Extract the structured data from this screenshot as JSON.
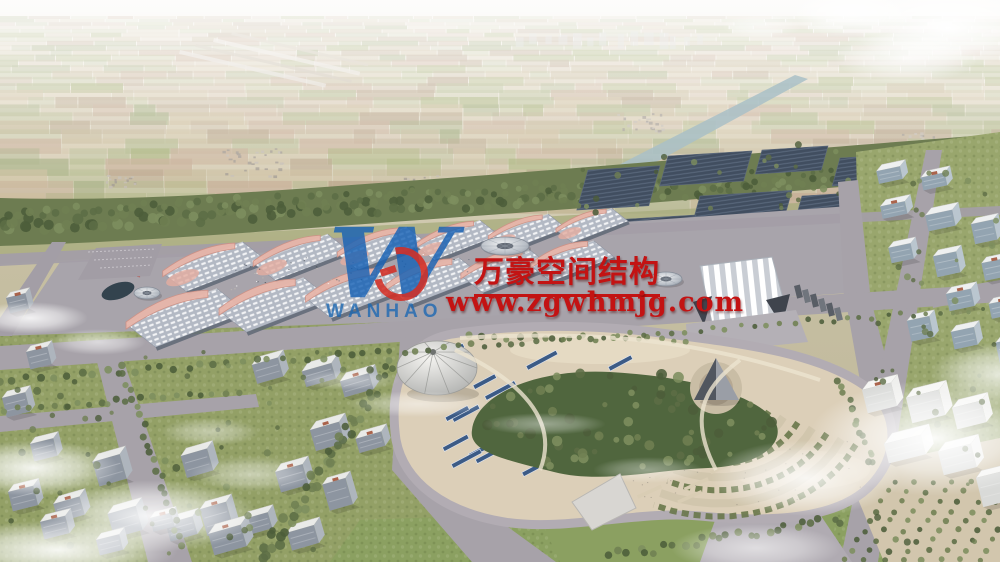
{
  "watermark": {
    "logo_letter": "W",
    "logo_subtext": "WANHAO",
    "brand_line": "万豪空间结构",
    "website": "www.zgwhmjg.com",
    "red": "#c31313",
    "blue": "#1d6ab4",
    "emblem_red": "#d32f26"
  },
  "scene": {
    "title": "Aerial masterplan rendering of an exhibition and convention complex",
    "palette": {
      "haze_top": "#f2efe8",
      "farm": [
        "#b9a982",
        "#a2aa74",
        "#bb9d80",
        "#919c66",
        "#c4b28c",
        "#a8906f",
        "#97a25e"
      ],
      "belt_green": "#6d7c51",
      "tree_greens": [
        "#4c5d3a",
        "#5c6d45",
        "#6f8052",
        "#7d8e5e"
      ],
      "road": "#a7a2a9",
      "apron": "#a8a4ab",
      "sand": "#dccfb8",
      "hall_roof": "#b3b9c4",
      "hall_edge": "#5f6876",
      "canopy_pink": "#e8b6aa",
      "canopy_pink_deep": "#cf9185",
      "solar_dark": "#414e60",
      "panel_blue": "#3c5b86",
      "pond": "#33434e",
      "canal": "#a9bfc7",
      "building_front": "#8d95a0",
      "building_side": "#aeb5bd",
      "building_roof": "#e9eae8",
      "roof_unit_red": "#a3543a",
      "white_tower": "#e6e7e5",
      "cloud": "#ffffff"
    }
  }
}
